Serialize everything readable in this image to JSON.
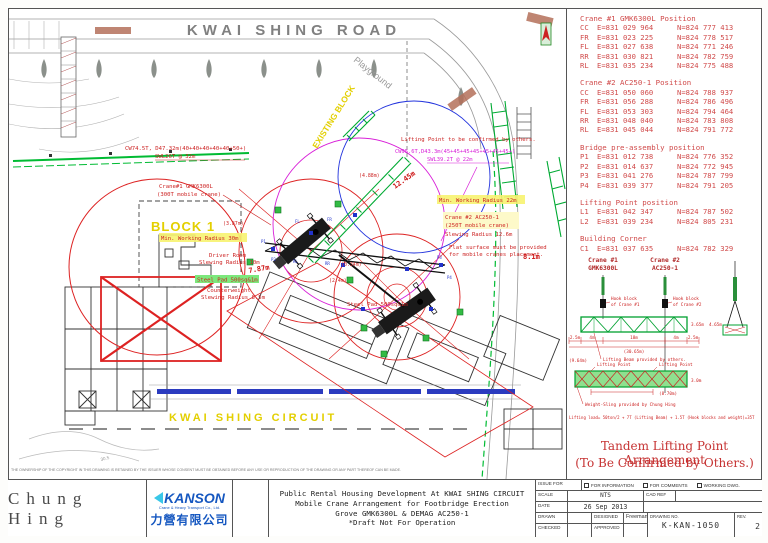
{
  "plan": {
    "labels": {
      "road_top": "KWAI SHING ROAD",
      "playground": "Playground",
      "existing_block": "EXISTING BLOCK",
      "block1": "BLOCK 1",
      "kwai_shing_circuit": "KWAI SHING CIRCUIT",
      "crane1_boom_note": "CW74.5T, D47.32m(40+40+40+40+40+50+)",
      "crane1_swl": "SWL26T @ 32m",
      "crane2_boom_note": "CW95.6T,D43.3m(45+45+45+45+45+45+45+)",
      "crane2_swl": "SWL39.2T @ 22m",
      "lifting_confirm_note": "Lifting Point to be confirmed by others.",
      "crane1_name": "Crane#1 GMK6300L",
      "crane1_type": "(300T mobile crane)",
      "crane2_name": "Crane #2  AC250-1",
      "crane2_type": "(250T mobile crane)",
      "min_radius_1": "Min. Working Radius 30m",
      "min_radius_2": "Min. Working Radius 22m",
      "driver_room_1": "Driver Room",
      "driver_room_2": "Slewing Radius 10m",
      "counterweight_1": "Counterweight",
      "counterweight_2": "Slewing Radius 8.5m",
      "slewing_2": "Slewing Radius 12.6m",
      "flat_surface_1": "Flat surface must be provided",
      "flat_surface_2": "for mobile cranes placement.",
      "steel_pad": "Steel Pad 500sq&1m",
      "dim_387": "(3.87m)",
      "dim_488": "(4.88m)",
      "dim_24": "(2.4m)",
      "dim_034": "(0.34m)",
      "dim_787": "7.87m",
      "dim_1245": "12.45m",
      "dim_81": "8.1m",
      "contour": "30.5",
      "p1": "P1",
      "p2": "P2",
      "p3": "P3",
      "p4": "P4",
      "fl": "FL",
      "fr": "FR",
      "rl": "RL",
      "rr": "RR",
      "disclaimer": "THE OWNERSHIP OF THE COPYRIGHT IN THIS DRAWING IS RETAINED BY THE ISSUER WHOSE CONSENT MUST BE OBTAINED BEFORE ANY USE OR REPRODUCTION OF THE DRAWING OR ANY PART THEREOF CAN BE MADE."
    }
  },
  "tables": {
    "crane1": {
      "title": "Crane #1 GMK6300L Position",
      "rows": [
        [
          "CC",
          "E=831 029 964",
          "N=824 777 413"
        ],
        [
          "FR",
          "E=831 023 225",
          "N=824 778 517"
        ],
        [
          "FL",
          "E=831 027 638",
          "N=824 771 246"
        ],
        [
          "RR",
          "E=831 030 821",
          "N=824 782 759"
        ],
        [
          "RL",
          "E=831 035 234",
          "N=824 775 488"
        ]
      ]
    },
    "crane2": {
      "title": "Crane #2 AC250-1 Position",
      "rows": [
        [
          "CC",
          "E=831 050 060",
          "N=824 788 937"
        ],
        [
          "FR",
          "E=831 056 288",
          "N=824 786 496"
        ],
        [
          "FL",
          "E=831 053 303",
          "N=824 794 464"
        ],
        [
          "RR",
          "E=831 048 040",
          "N=824 783 808"
        ],
        [
          "RL",
          "E=831 045 044",
          "N=824 791 772"
        ]
      ]
    },
    "bridge": {
      "title": "Bridge pre-assembly position",
      "rows": [
        [
          "P1",
          "E=831 012 738",
          "N=824 776 352"
        ],
        [
          "P2",
          "E=831 014 637",
          "N=824 772 945"
        ],
        [
          "P3",
          "E=831 041 276",
          "N=824 787 799"
        ],
        [
          "P4",
          "E=831 039 377",
          "N=824 791 205"
        ]
      ]
    },
    "lifting": {
      "title": "Lifting Point position",
      "rows": [
        [
          "L1",
          "E=831 042 347",
          "N=824 787 502"
        ],
        [
          "L2",
          "E=831 039 234",
          "N=824 805 231"
        ]
      ]
    },
    "corner": {
      "title": "Building Corner",
      "rows": [
        [
          "C1",
          "E=831 037 635",
          "N=824 782 329"
        ]
      ]
    }
  },
  "tandem": {
    "crane1_header_l1": "Crane #1",
    "crane1_header_l2": "GMK6300L",
    "crane2_header_l1": "Crane #2",
    "crane2_header_l2": "AC250-1",
    "hook1_l1": "Hook block",
    "hook1_l2": "of Crane #1",
    "hook2_l1": "Hook block",
    "hook2_l2": "of Crane #2",
    "dims": [
      "2.5m",
      "4m",
      "18m",
      "4m",
      "2.5m"
    ],
    "total_dim": "(30.65m)",
    "height_dim_1": "3.65m",
    "height_dim_2": "4.65m",
    "beam_note": "Lifting Beam provided by others.",
    "lp_label": "Lifting Point",
    "lp_left_dim": "(9.64m)",
    "lp_bottom_dim": "(8.70m)",
    "lp_height": "3.0m",
    "sling_note": "Weight-Sling provided by Chung Hing",
    "load_note": "Lifting load= 50ton/2 + 7T (Lifting Beam) + 1.5T (Hook blocks and weight)=35T",
    "title_l1": "Tandem Lifting Point Arrangement",
    "title_l2": "(To Be Confirmed by Others.)"
  },
  "title_block": {
    "company": "Chung Hing",
    "logo_text": "KANSON",
    "logo_sub": "Crane & Heavy Transport Co., Ltd.",
    "logo_cn": "力營有限公司",
    "project_line1": "Public Rental Housing Development At KWAI SHING CIRCUIT",
    "project_line2": "Mobile Crane Arrangement for Footbridge Erection",
    "project_line3": "Grove GMK6300L & DEMAG AC250-1",
    "project_line4": "*Draft Not For Operation",
    "issue_for": "ISSUE FOR",
    "checkboxes": [
      "FOR INFORMATION",
      "FOR COMMENTS",
      "WORKING DWG."
    ],
    "scale_label": "SCALE",
    "scale": "NTS",
    "cad_ref_label": "CAD REF",
    "date_label": "DATE",
    "date": "26 Sep 2013",
    "drawn_label": "DRAWN",
    "designed_label": "DESIGNED",
    "designer": "Freeman",
    "checked_label": "CHECKED",
    "approved_label": "APPROVED",
    "drawing_no_label": "DRAWING NO.",
    "drawing_no": "K-KAN-1050",
    "rev_label": "REV.",
    "rev": "2"
  }
}
